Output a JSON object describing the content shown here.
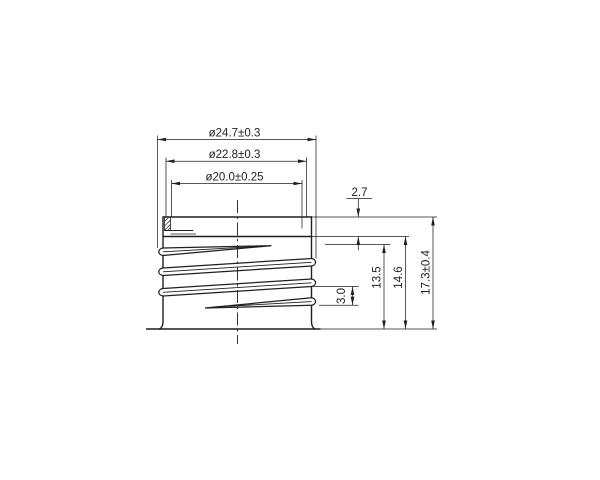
{
  "drawing": {
    "type": "engineering dimension drawing",
    "subject": "bottle neck screw-thread finish, front elevation with partial top section and helical thread crests",
    "background_color": "#ffffff",
    "line_color": "#1f1f1f",
    "dimensions": {
      "thread_od": "ø24.7±0.3",
      "root_od": "ø22.8±0.3",
      "bore_id": "ø20.0±0.25",
      "top_to_thread": "2.7",
      "thread_pitch": "3.0",
      "thread_start_height": "13.5",
      "thread_end_height": "14.6",
      "overall_height": "17.3±0.4"
    }
  }
}
